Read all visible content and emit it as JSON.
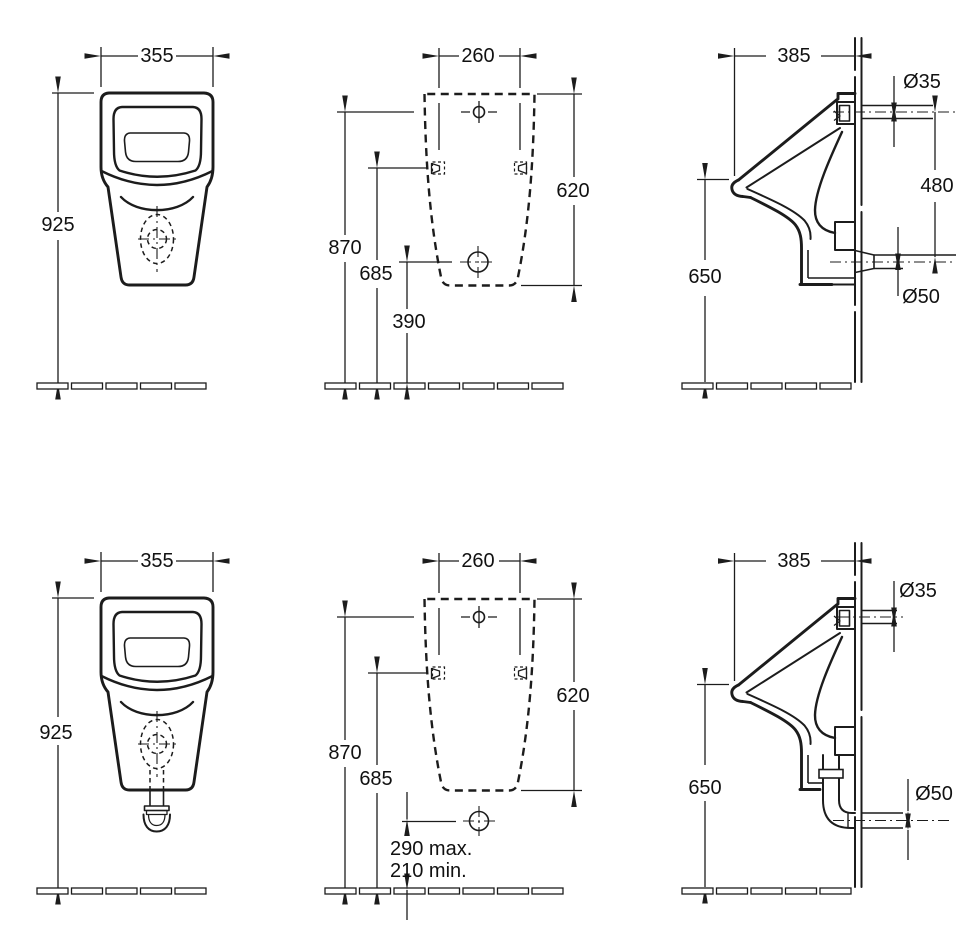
{
  "page": {
    "background": "#ffffff",
    "line_color": "#1c1c1c"
  },
  "views": {
    "top_front": {
      "width_mm": "355",
      "height_mm": "925"
    },
    "top_rear": {
      "hole_spacing_mm": "260",
      "fixing_field_height_mm": "620",
      "inlet_height_mm": "870",
      "fixing_height_mm": "685",
      "outlet_height_mm": "390"
    },
    "top_side": {
      "depth_mm": "385",
      "inlet_diameter": "Ø35",
      "inlet_to_outlet_mm": "480",
      "outlet_diameter": "Ø50",
      "rim_height_mm": "650"
    },
    "bottom_front": {
      "width_mm": "355",
      "height_mm": "925"
    },
    "bottom_rear": {
      "hole_spacing_mm": "260",
      "fixing_field_height_mm": "620",
      "inlet_height_mm": "870",
      "fixing_height_mm": "685",
      "outlet_height_max": "290 max.",
      "outlet_height_min": "210 min."
    },
    "bottom_side": {
      "depth_mm": "385",
      "inlet_diameter": "Ø35",
      "outlet_diameter": "Ø50",
      "rim_height_mm": "650"
    }
  }
}
